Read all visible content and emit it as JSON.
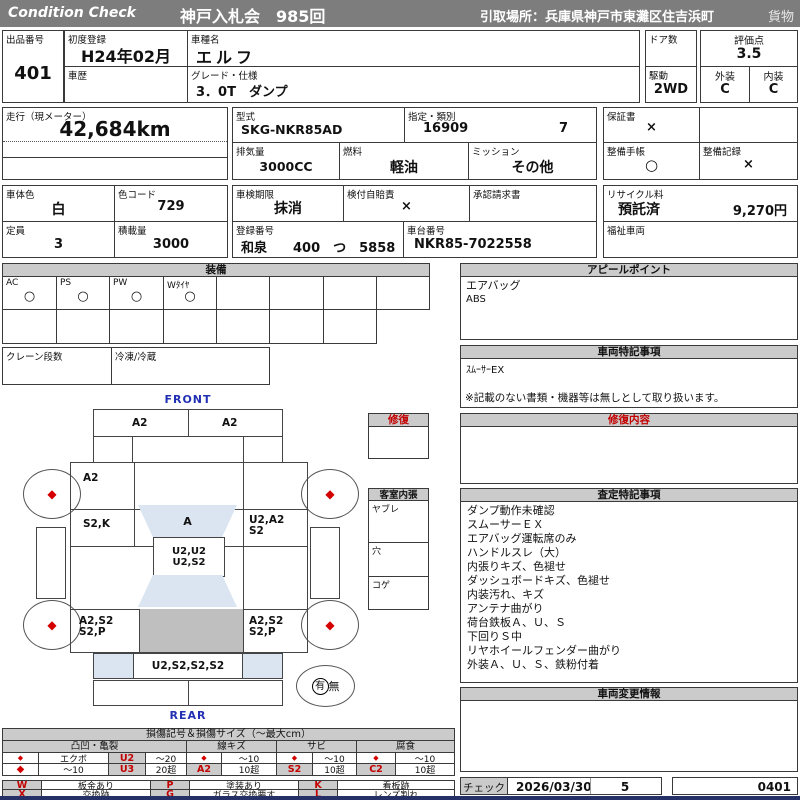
{
  "header": {
    "brand": "Condition  Check",
    "auction": "神戸入札会　985回",
    "pickup": "引取場所：兵庫県神戸市東灘区住吉浜町",
    "category": "貨物"
  },
  "info": {
    "lot_label": "出品番号",
    "lot_value": "401",
    "first_reg_label": "初度登録",
    "first_reg_value": "H24年02月",
    "history_label": "車歴",
    "model_name_label": "車種名",
    "model_name_value": "エルフ",
    "grade_label": "グレード・仕様",
    "grade_value": "3．0T　ダンプ",
    "doors_label": "ドア数",
    "score_label": "評価点",
    "score_value": "3.5",
    "drive_label": "駆動",
    "drive_value": "2WD",
    "exterior_label": "外装",
    "exterior_value": "C",
    "interior_label": "内装",
    "interior_value": "C",
    "mileage_label": "走行（現メーター）",
    "mileage_value": "42,684km",
    "model_code_label": "型式",
    "model_code_value": "SKG-NKR85AD",
    "class_label": "指定・類別",
    "class_value1": "16909",
    "class_value2": "7",
    "warranty_label": "保証書",
    "warranty_value": "×",
    "displacement_label": "排気量",
    "displacement_value": "3000CC",
    "fuel_label": "燃料",
    "fuel_value": "軽油",
    "mission_label": "ミッション",
    "mission_value": "その他",
    "maintenance_book_label": "整備手帳",
    "maintenance_book_value": "○",
    "maintenance_record_label": "整備記録",
    "maintenance_record_value": "×",
    "color_label": "車体色",
    "color_value": "白",
    "color_code_label": "色コード",
    "color_code_value": "729",
    "inspection_label": "車検期限",
    "inspection_value": "抹消",
    "insurance_label": "検付自賠責",
    "insurance_value": "×",
    "approval_label": "承認請求書",
    "recycle_label": "リサイクル料",
    "recycle_value": "預託済",
    "recycle_fee": "9,270円",
    "capacity_label": "定員",
    "capacity_value": "3",
    "load_label": "積載量",
    "load_value": "3000",
    "reg_no_label": "登録番号",
    "reg_no_value": "和泉　　400　つ　5858",
    "chassis_label": "車台番号",
    "chassis_value": "NKR85-7022558",
    "welfare_label": "福祉車両"
  },
  "equipment": {
    "title": "装備",
    "items": [
      {
        "label": "AC",
        "value": "○"
      },
      {
        "label": "PS",
        "value": "○"
      },
      {
        "label": "PW",
        "value": "○"
      },
      {
        "label": "Wﾀｲﾔ",
        "value": "○"
      }
    ],
    "crane_label": "クレーン段数",
    "reefer_label": "冷凍/冷蔵"
  },
  "appeal": {
    "title": "アピールポイント",
    "lines": [
      "エアバッグ",
      "ABS"
    ]
  },
  "vehicle_notes": {
    "title": "車両特記事項",
    "lines": [
      "ｽﾑｰｻｰEX"
    ],
    "disclaimer": "※記載のない書類・機器等は無しとして取り扱います。"
  },
  "repair": {
    "title": "修復"
  },
  "repair_detail": {
    "title": "修復内容"
  },
  "cabin": {
    "title": "客室内張",
    "sections": [
      "ヤブレ",
      "穴",
      "コゲ"
    ]
  },
  "assessment": {
    "title": "査定特記事項",
    "lines": [
      "ダンプ動作未確認",
      "スムーサーＥＸ",
      "エアバッグ運転席のみ",
      "ハンドルスレ（大）",
      "内張りキズ、色褪せ",
      "ダッシュボードキズ、色褪せ",
      "内装汚れ、キズ",
      "アンテナ曲がり",
      "荷台鉄板Ａ、Ｕ、Ｓ",
      "下回りＳ中",
      "リヤホイールフェンダー曲がり",
      "外装Ａ、Ｕ、Ｓ、鉄粉付着"
    ]
  },
  "change_info": {
    "title": "車両変更情報"
  },
  "check": {
    "label": "チェック",
    "date": "2026/03/30",
    "number": "5",
    "code": "0401"
  },
  "diagram": {
    "front_label": "FRONT",
    "rear_label": "REAR",
    "front_bumper_left": "A2",
    "front_bumper_right": "A2",
    "front_panel_left": "A2",
    "left_door": "S2,K",
    "windshield": "A",
    "right_door_line1": "U2,A2",
    "right_door_line2": "S2",
    "roof_line1": "U2,U2",
    "roof_line2": "U2,S2",
    "rear_left_line1": "A2,S2",
    "rear_left_line2": "S2,P",
    "rear_right_line1": "A2,S2",
    "rear_right_line2": "S2,P",
    "tailgate": "U2,S2,S2,S2",
    "wheel_mark": "◆",
    "spare_present": "有",
    "spare_absent": "無"
  },
  "legend": {
    "title": "損傷記号＆損傷サイズ（～最大cm）",
    "group_dent": "凸凹・亀裂",
    "group_scratch": "線キズ",
    "group_rust": "サビ",
    "group_corrosion": "腐食",
    "dent_r1": [
      "◆",
      "エクボ",
      "U2",
      "～20"
    ],
    "dent_r2": [
      "◆",
      "～10",
      "U3",
      "20超"
    ],
    "scratch_r1": [
      "◆",
      "～10"
    ],
    "scratch_r2": [
      "A2",
      "10超"
    ],
    "rust_r1": [
      "◆",
      "～10"
    ],
    "rust_r2": [
      "S2",
      "10超"
    ],
    "corrosion_r1": [
      "◆",
      "～10"
    ],
    "corrosion_r2": [
      "C2",
      "10超"
    ],
    "codes": [
      {
        "code": "W",
        "desc": "板金あり"
      },
      {
        "code": "P",
        "desc": "塗装あり"
      },
      {
        "code": "K",
        "desc": "看板跡"
      },
      {
        "code": "X",
        "desc": "交換跡"
      },
      {
        "code": "G",
        "desc": "ガラス交換要す"
      },
      {
        "code": "L",
        "desc": "レンズ割れ"
      }
    ]
  },
  "colors": {
    "header_bg": "#7d7d7d",
    "section_bg": "#cbcbcb",
    "accent_red": "#c40000",
    "label_blue": "#2230b4",
    "shade_blue": "#dbe5f1",
    "shade_gray": "#bfbfbf"
  }
}
